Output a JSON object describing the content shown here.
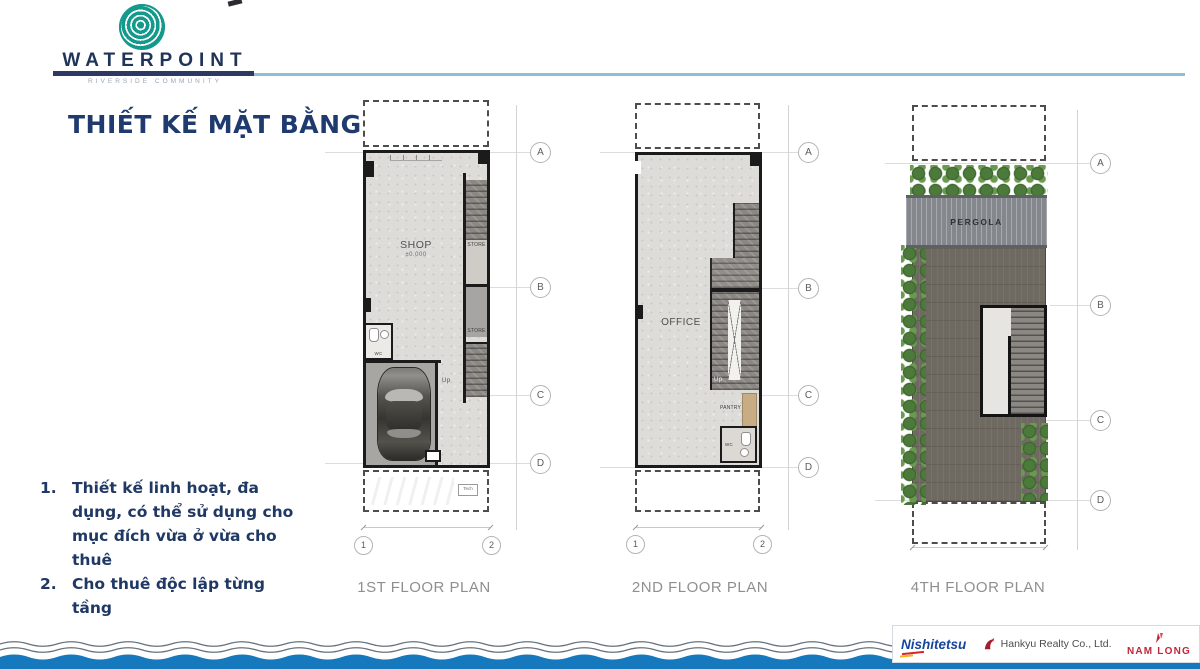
{
  "header": {
    "brand": "WATERPOINT",
    "brand_subtitle": "RIVERSIDE COMMUNITY",
    "title": "THIẾT KẾ MẶT BẰNG"
  },
  "notes": {
    "items": [
      {
        "num": "1.",
        "text": "Thiết kế linh hoạt, đa dụng, có thể sử dụng cho mục đích vừa ở vừa cho thuê"
      },
      {
        "num": "2.",
        "text": "Cho thuê độc lập từng tầng"
      }
    ]
  },
  "plans": {
    "plan1": {
      "label": "1ST FLOOR PLAN",
      "shop": "SHOP",
      "shop_level": "±0.000",
      "store_upper": "STORE",
      "store_lower": "STORE",
      "wc": "WC",
      "up": "Up",
      "tech": "Tech",
      "grid_a": "A",
      "grid_b": "B",
      "grid_c": "C",
      "grid_d": "D",
      "col_1": "1",
      "col_2": "2"
    },
    "plan2": {
      "label": "2ND FLOOR PLAN",
      "office": "OFFICE",
      "pantry": "PANTRY",
      "wc": "WC",
      "up": "Up",
      "grid_a": "A",
      "grid_b": "B",
      "grid_c": "C",
      "grid_d": "D",
      "col_1": "1",
      "col_2": "2"
    },
    "plan4": {
      "label": "4TH FLOOR PLAN",
      "pergola": "PERGOLA",
      "grid_a": "A",
      "grid_b": "B",
      "grid_c": "C",
      "grid_d": "D"
    }
  },
  "footer": {
    "nishitetsu": "Nishitetsu",
    "hankyu": "Hankyu Realty Co., Ltd.",
    "namlong": "NAM LONG"
  },
  "colors": {
    "logo_teal": "#149a8c",
    "navy": "#1f3864",
    "rule_blue": "#8cc0d6",
    "wave_blue": "#1779bd",
    "plan_label_gray": "#8f8f8f"
  }
}
